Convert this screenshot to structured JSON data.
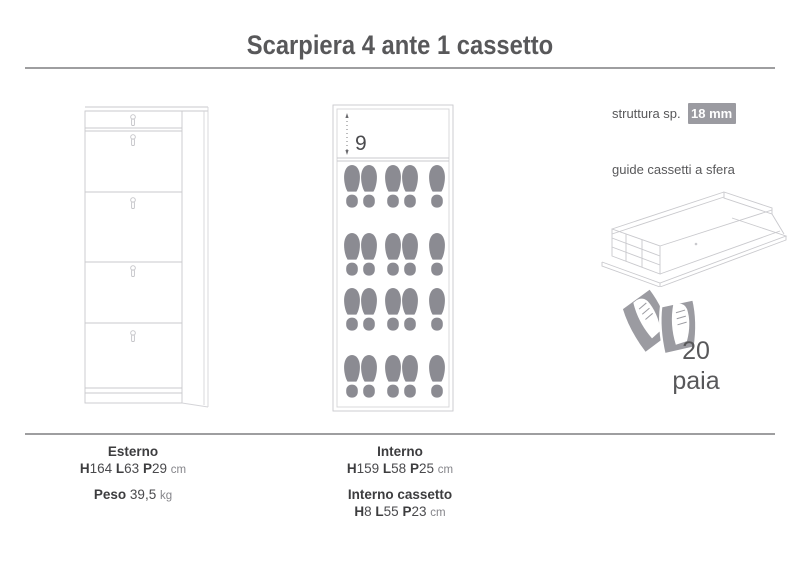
{
  "title": "Scarpiera 4 ante 1 cassetto",
  "right_panel": {
    "structure_label": "struttura sp.",
    "structure_value": "18 mm",
    "slides_label": "guide cassetti a sfera",
    "capacity_value": "20",
    "capacity_unit": "paia"
  },
  "interior_diagram": {
    "drawer_depth_label": "9",
    "footprint_rows": 4,
    "footprints_per_row": 5
  },
  "illustrations": {
    "left": "cabinet-front-line-drawing",
    "middle": "cabinet-interior-footprints",
    "drawer": "ball-bearing-drawer-slides",
    "shoes": "pair-of-shoes-on-flap"
  },
  "bottom": {
    "esterno": {
      "label": "Esterno",
      "h_key": "H",
      "h_val": "164",
      "l_key": "L",
      "l_val": "63",
      "p_key": "P",
      "p_val": "29",
      "unit": "cm",
      "peso_label": "Peso",
      "peso_val": "39,5",
      "peso_unit": "kg"
    },
    "interno": {
      "label": "Interno",
      "h_key": "H",
      "h_val": "159",
      "l_key": "L",
      "l_val": "58",
      "p_key": "P",
      "p_val": "25",
      "unit": "cm"
    },
    "interno_cassetto": {
      "label": "Interno cassetto",
      "h_key": "H",
      "h_val": "8",
      "l_key": "L",
      "l_val": "55",
      "p_key": "P",
      "p_val": "23",
      "unit": "cm"
    }
  },
  "colors": {
    "footprint_gray": "#8b8b92",
    "badge_gray": "#9b9ba1",
    "rule_gray": "#9e9ea0",
    "text_dark": "#4a4a4d"
  }
}
